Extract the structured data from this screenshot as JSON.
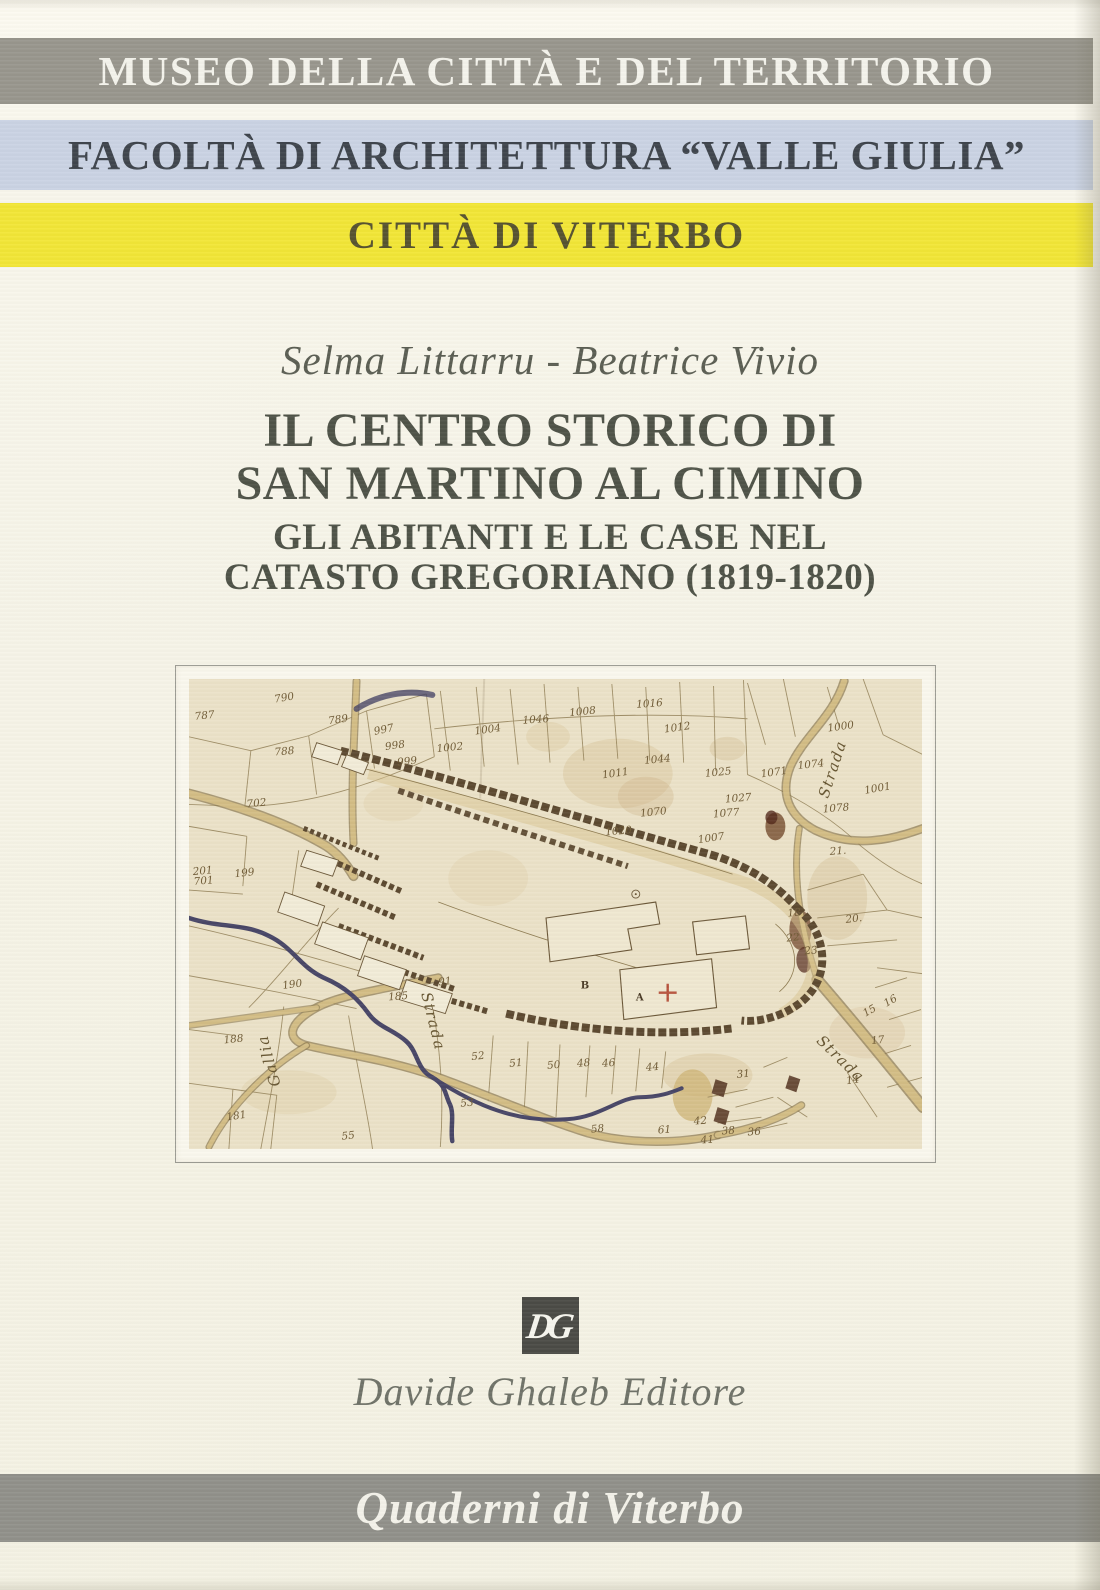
{
  "banners": {
    "museo": "MUSEO DELLA CITTÀ E DEL TERRITORIO",
    "facolta": "FACOLTÀ DI ARCHITETTURA “VALLE GIULIA”",
    "citta": "CITTÀ DI VITERBO",
    "series": "Quaderni di Viterbo"
  },
  "authors": "Selma Littarru - Beatrice Vivio",
  "title": {
    "line1": "IL CENTRO STORICO DI",
    "line2": "SAN MARTINO AL CIMINO"
  },
  "subtitle": {
    "line1": "GLI ABITANTI E LE CASE NEL",
    "line2": "CATASTO GREGORIANO (1819-1820)"
  },
  "publisher": {
    "logo_text": "DG",
    "name": "Davide Ghaleb Editore"
  },
  "colors": {
    "banner_gray": "#98968d",
    "banner_blue": "#cad3e4",
    "banner_yellow": "#f2e636",
    "banner_series_gray": "#90908a",
    "cover_cream": "#f6f4e8",
    "map_paper": "#ebe2c8",
    "map_ink": "#8d7a50",
    "stream_blue": "#474566",
    "cross_red": "#b5503a"
  },
  "map": {
    "parcel_numbers": [
      {
        "t": "787",
        "x": 16,
        "y": 40,
        "r": -6
      },
      {
        "t": "790",
        "x": 96,
        "y": 22,
        "r": -10
      },
      {
        "t": "789",
        "x": 150,
        "y": 44,
        "r": -8
      },
      {
        "t": "788",
        "x": 96,
        "y": 76,
        "r": -5
      },
      {
        "t": "997",
        "x": 196,
        "y": 54,
        "r": -12
      },
      {
        "t": "998",
        "x": 207,
        "y": 70,
        "r": -8
      },
      {
        "t": "999",
        "x": 219,
        "y": 86,
        "r": -6
      },
      {
        "t": "1002",
        "x": 262,
        "y": 72,
        "r": -6
      },
      {
        "t": "1004",
        "x": 300,
        "y": 54,
        "r": -8
      },
      {
        "t": "1046",
        "x": 348,
        "y": 44,
        "r": -4
      },
      {
        "t": "1008",
        "x": 395,
        "y": 36,
        "r": -6
      },
      {
        "t": "1016",
        "x": 462,
        "y": 28,
        "r": -4
      },
      {
        "t": "1012",
        "x": 490,
        "y": 52,
        "r": -8
      },
      {
        "t": "1044",
        "x": 470,
        "y": 84,
        "r": -6
      },
      {
        "t": "1011",
        "x": 428,
        "y": 98,
        "r": -8
      },
      {
        "t": "1025",
        "x": 531,
        "y": 97,
        "r": -6
      },
      {
        "t": "1027",
        "x": 551,
        "y": 123,
        "r": -5
      },
      {
        "t": "1007",
        "x": 524,
        "y": 163,
        "r": -8
      },
      {
        "t": "1020",
        "x": 431,
        "y": 156,
        "r": -5
      },
      {
        "t": "1070",
        "x": 466,
        "y": 137,
        "r": -6
      },
      {
        "t": "1077",
        "x": 539,
        "y": 138,
        "r": -5
      },
      {
        "t": "1071",
        "x": 587,
        "y": 97,
        "r": -8
      },
      {
        "t": "1074",
        "x": 624,
        "y": 89,
        "r": -6
      },
      {
        "t": "1078",
        "x": 649,
        "y": 133,
        "r": -5
      },
      {
        "t": "1000",
        "x": 654,
        "y": 51,
        "r": -8
      },
      {
        "t": "1001",
        "x": 691,
        "y": 113,
        "r": -10
      },
      {
        "t": "21.",
        "x": 651,
        "y": 176,
        "r": -4
      },
      {
        "t": "20.",
        "x": 667,
        "y": 244,
        "r": -6
      },
      {
        "t": "18",
        "x": 607,
        "y": 238,
        "r": -5
      },
      {
        "t": "22",
        "x": 606,
        "y": 263,
        "r": -6
      },
      {
        "t": "23",
        "x": 624,
        "y": 276,
        "r": -5
      },
      {
        "t": "15",
        "x": 684,
        "y": 336,
        "r": -30
      },
      {
        "t": "16",
        "x": 705,
        "y": 326,
        "r": -30
      },
      {
        "t": "17",
        "x": 691,
        "y": 366,
        "r": -6
      },
      {
        "t": "14",
        "x": 666,
        "y": 406,
        "r": -8
      },
      {
        "t": "31",
        "x": 556,
        "y": 400,
        "r": -5
      },
      {
        "t": "36",
        "x": 567,
        "y": 458,
        "r": -4
      },
      {
        "t": "38",
        "x": 541,
        "y": 457,
        "r": -4
      },
      {
        "t": "41",
        "x": 520,
        "y": 466,
        "r": -4
      },
      {
        "t": "42",
        "x": 513,
        "y": 447,
        "r": -5
      },
      {
        "t": "61",
        "x": 477,
        "y": 456,
        "r": -4
      },
      {
        "t": "58",
        "x": 410,
        "y": 455,
        "r": -6
      },
      {
        "t": "53",
        "x": 279,
        "y": 429,
        "r": -5
      },
      {
        "t": "52",
        "x": 290,
        "y": 382,
        "r": -6
      },
      {
        "t": "51",
        "x": 328,
        "y": 389,
        "r": -5
      },
      {
        "t": "50",
        "x": 366,
        "y": 391,
        "r": -5
      },
      {
        "t": "48",
        "x": 396,
        "y": 389,
        "r": -5
      },
      {
        "t": "46",
        "x": 421,
        "y": 389,
        "r": -5
      },
      {
        "t": "44",
        "x": 465,
        "y": 393,
        "r": -5
      },
      {
        "t": "55",
        "x": 160,
        "y": 462,
        "r": -6
      },
      {
        "t": "190",
        "x": 104,
        "y": 310,
        "r": -8
      },
      {
        "t": "188",
        "x": 45,
        "y": 365,
        "r": -6
      },
      {
        "t": "185",
        "x": 210,
        "y": 322,
        "r": -5
      },
      {
        "t": "91",
        "x": 257,
        "y": 307,
        "r": -6
      },
      {
        "t": "702",
        "x": 68,
        "y": 128,
        "r": -6
      },
      {
        "t": "701",
        "x": 15,
        "y": 206,
        "r": -5
      },
      {
        "t": "199",
        "x": 56,
        "y": 198,
        "r": -6
      },
      {
        "t": "201",
        "x": 14,
        "y": 196,
        "r": -5
      },
      {
        "t": "181",
        "x": 48,
        "y": 442,
        "r": -8
      }
    ],
    "road_labels": [
      {
        "t": "Strada",
        "x": 650,
        "y": 92,
        "r": -72
      },
      {
        "t": "Strada",
        "x": 650,
        "y": 385,
        "r": 44
      },
      {
        "t": "Strada",
        "x": 240,
        "y": 345,
        "r": 76
      },
      {
        "t": "Gallia",
        "x": 85,
        "y": 382,
        "r": -105
      }
    ],
    "building_letters": [
      {
        "t": "B",
        "x": 397,
        "y": 311
      },
      {
        "t": "A",
        "x": 452,
        "y": 323
      }
    ]
  }
}
